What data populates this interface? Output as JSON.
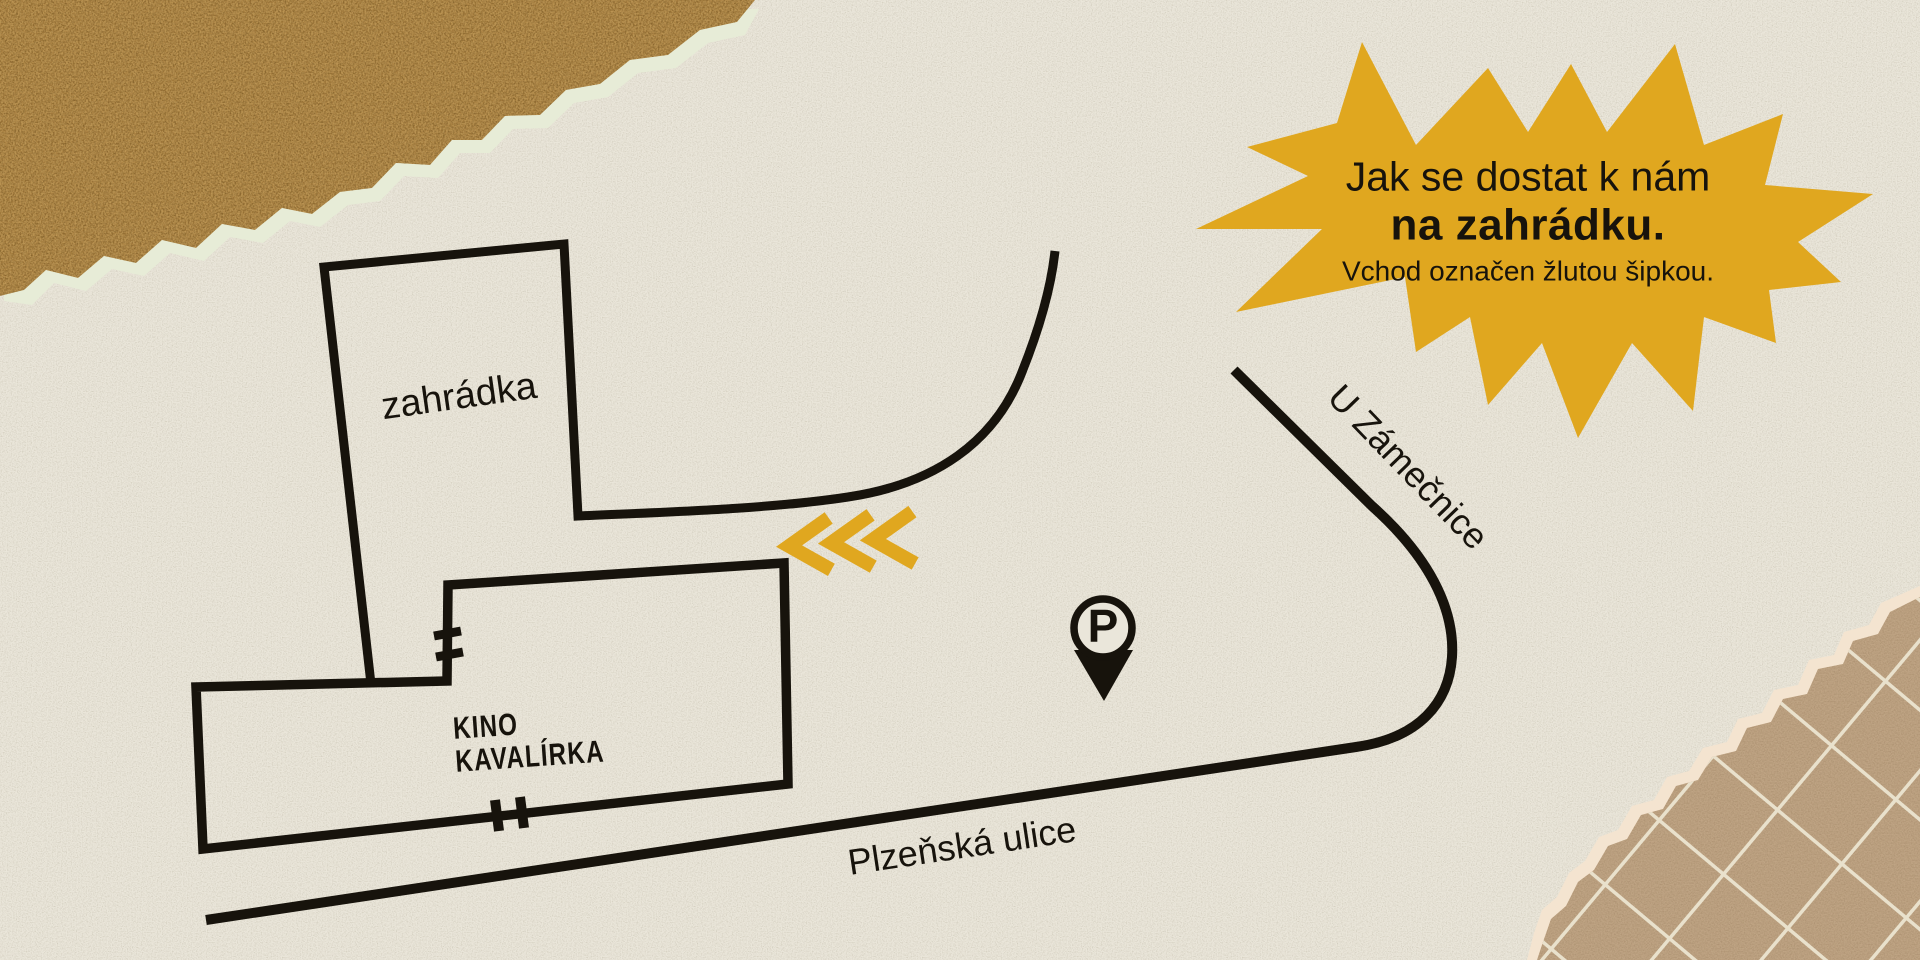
{
  "poster": {
    "title_callout": {
      "line1": "Jak se dostat k nám",
      "line2": "na zahrádku.",
      "line3": "Vchod označen žlutou šipkou."
    },
    "map_labels": {
      "garden": "zahrádka",
      "cinema": [
        "KINO",
        "KAVALÍRKA"
      ],
      "street_side": "U Zámečnice",
      "street_main": "Plzeňská ulice",
      "parking_letter": "P"
    },
    "icons": {
      "parking": "map-pin-with-P-icon",
      "entrance_direction": "triple-chevron-left-icon"
    },
    "colors": {
      "paper_background": "#eae6da",
      "accent_yellow": "#e0a71f",
      "map_ink_black": "#17130c",
      "kraft_brown": "#a37a3c",
      "grid_paper_tan": "#bfa484",
      "grid_line": "#e9e1cc",
      "torn_edge_cream": "#f4e4d0"
    }
  }
}
